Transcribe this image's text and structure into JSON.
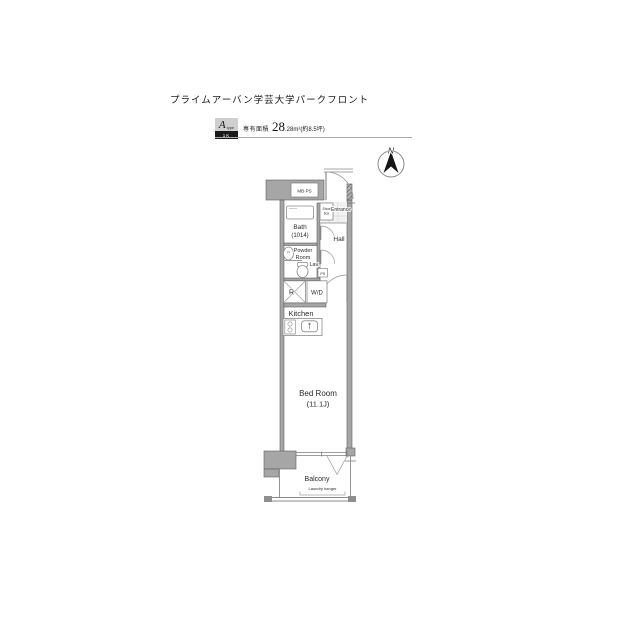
{
  "header": {
    "title": "プライムアーバン学芸大学パークフロント",
    "type_letter": "A",
    "type_suffix": "type",
    "type_badge": "1K",
    "area_label": "専有面積",
    "area_main": "28",
    "area_sub": ".28m²",
    "area_note": "(約8.5坪)"
  },
  "compass": {
    "north": "N"
  },
  "rooms": {
    "mbps": "MB·PS",
    "entrance": "Entrance",
    "shoe_1": "Shoe",
    "shoe_2": "box",
    "bath": "Bath",
    "bath_size": "(1014)",
    "hall": "Hall",
    "powder_1": "Powder",
    "powder_2": "Room",
    "lav": "Lav.",
    "ps": "PS",
    "fridge": "R",
    "washer": "W/D",
    "kitchen": "Kitchen",
    "bedroom": "Bed Room",
    "bedroom_size": "(11.1J)",
    "balcony": "Balcony",
    "laundry": "Laundry hanger"
  }
}
